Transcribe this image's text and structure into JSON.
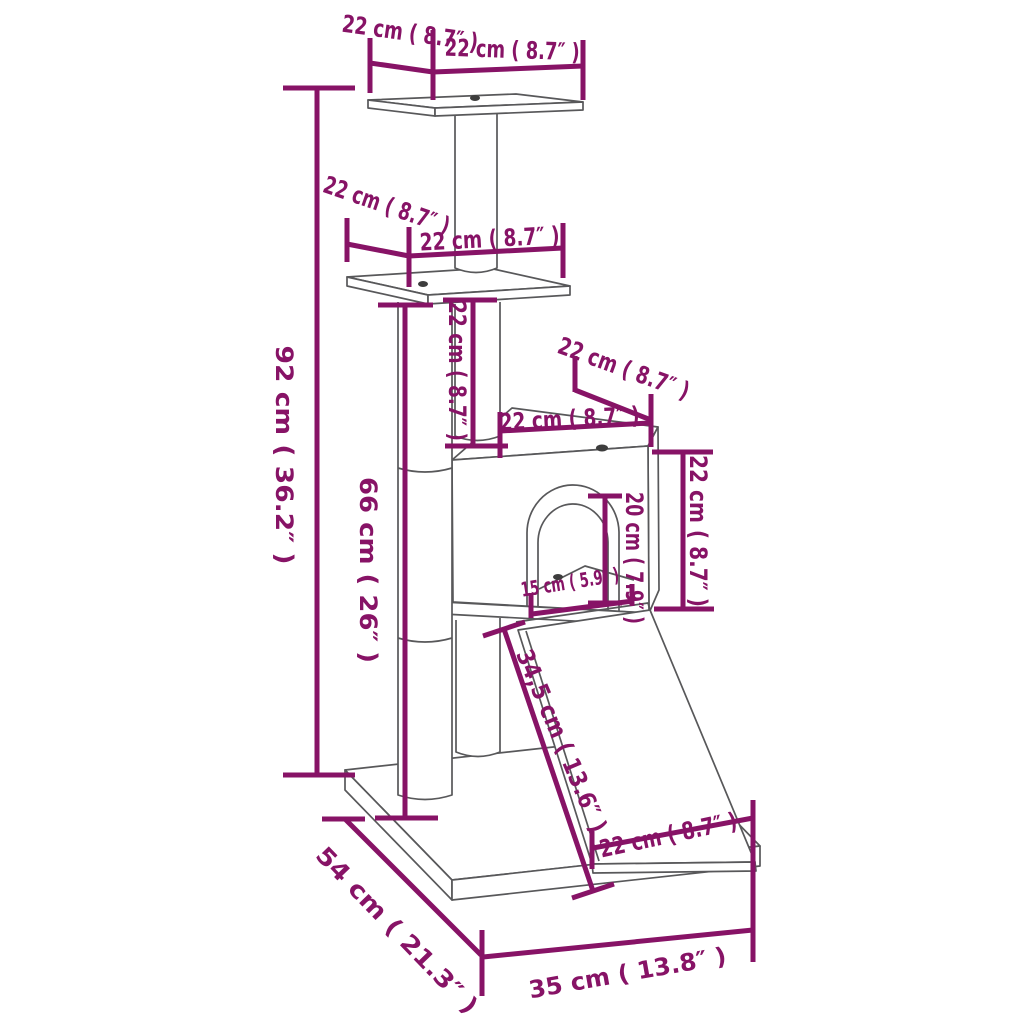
{
  "diagram": {
    "title": "Cat tree with scratching posts - dimension diagram",
    "colors": {
      "dimension_accent": "#871366",
      "drawing_line": "#58585a",
      "background": "#ffffff"
    },
    "dimensions": {
      "top_platform_depth": "22 cm ( 8.7″ )",
      "top_platform_width": "22 cm ( 8.7″ )",
      "mid_platform_depth": "22 cm ( 8.7″ )",
      "mid_platform_width": "22 cm ( 8.7″ )",
      "total_height": "92 cm ( 36.2″ )",
      "main_post_height": "66 cm ( 26″ )",
      "upper_post_height": "22 cm ( 8.7″ )",
      "house_depth": "22 cm ( 8.7″ )",
      "house_width": "22 cm ( 8.7″ )",
      "house_height": "22 cm ( 8.7″ )",
      "door_height": "20 cm ( 7.9″ )",
      "door_width": "15 cm ( 5.9″ )",
      "ramp_length": "34,5 cm ( 13.6″ )",
      "ramp_width": "22 cm ( 8.7″ )",
      "base_depth": "54 cm ( 21.3″ )",
      "base_width": "35 cm ( 13.8″ )"
    }
  }
}
